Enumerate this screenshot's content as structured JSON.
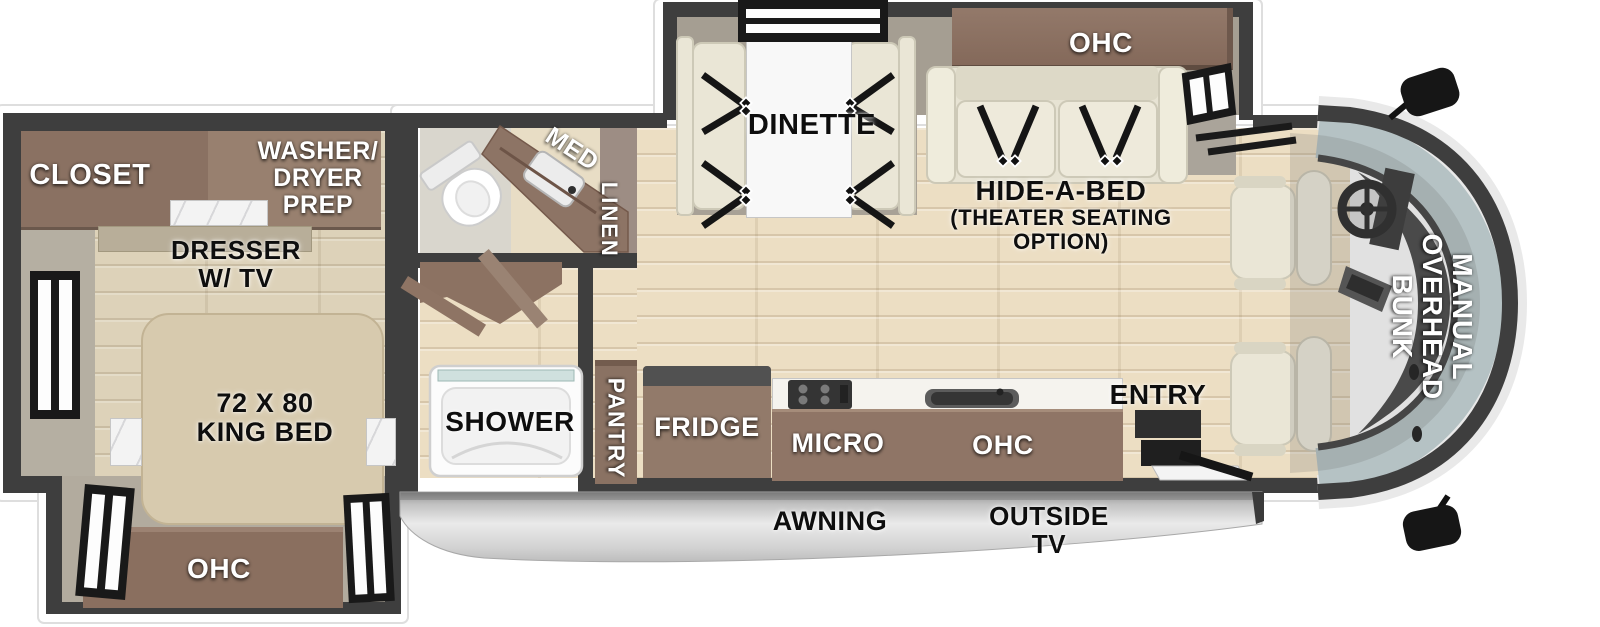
{
  "labels": {
    "bedroom": {
      "closet": "CLOSET",
      "washer_dryer_prep": "WASHER/\nDRYER\nPREP",
      "dresser_tv": "DRESSER\nW/ TV",
      "king_bed": "72 X 80\nKING BED",
      "ohc": "OHC"
    },
    "bathroom": {
      "med": "MED",
      "linen": "LINEN",
      "shower": "SHOWER"
    },
    "kitchen": {
      "pantry": "PANTRY",
      "fridge": "FRIDGE",
      "micro": "MICRO",
      "ohc": "OHC",
      "entry": "ENTRY"
    },
    "living": {
      "dinette": "DINETTE",
      "ohc": "OHC",
      "hide_a_bed": "HIDE-A-BED",
      "theater_option": "(THEATER SEATING\nOPTION)"
    },
    "cab": {
      "overhead_bunk": "MANUAL\nOVERHEAD\nBUNK"
    },
    "exterior": {
      "awning": "AWNING",
      "outside_tv": "OUTSIDE\nTV"
    }
  },
  "palette": {
    "wall": "#3e3e3e",
    "cabinet_brown": "#8f7566",
    "floor_wood": "#ecdec3",
    "floor_gray": "#a59e92",
    "upholstery": "#eae6d6",
    "windshield_glass": "#b5c2c4",
    "awning_gray": "#d9d9d9",
    "label_white": "#ffffff",
    "label_black": "#0e0e0e"
  }
}
